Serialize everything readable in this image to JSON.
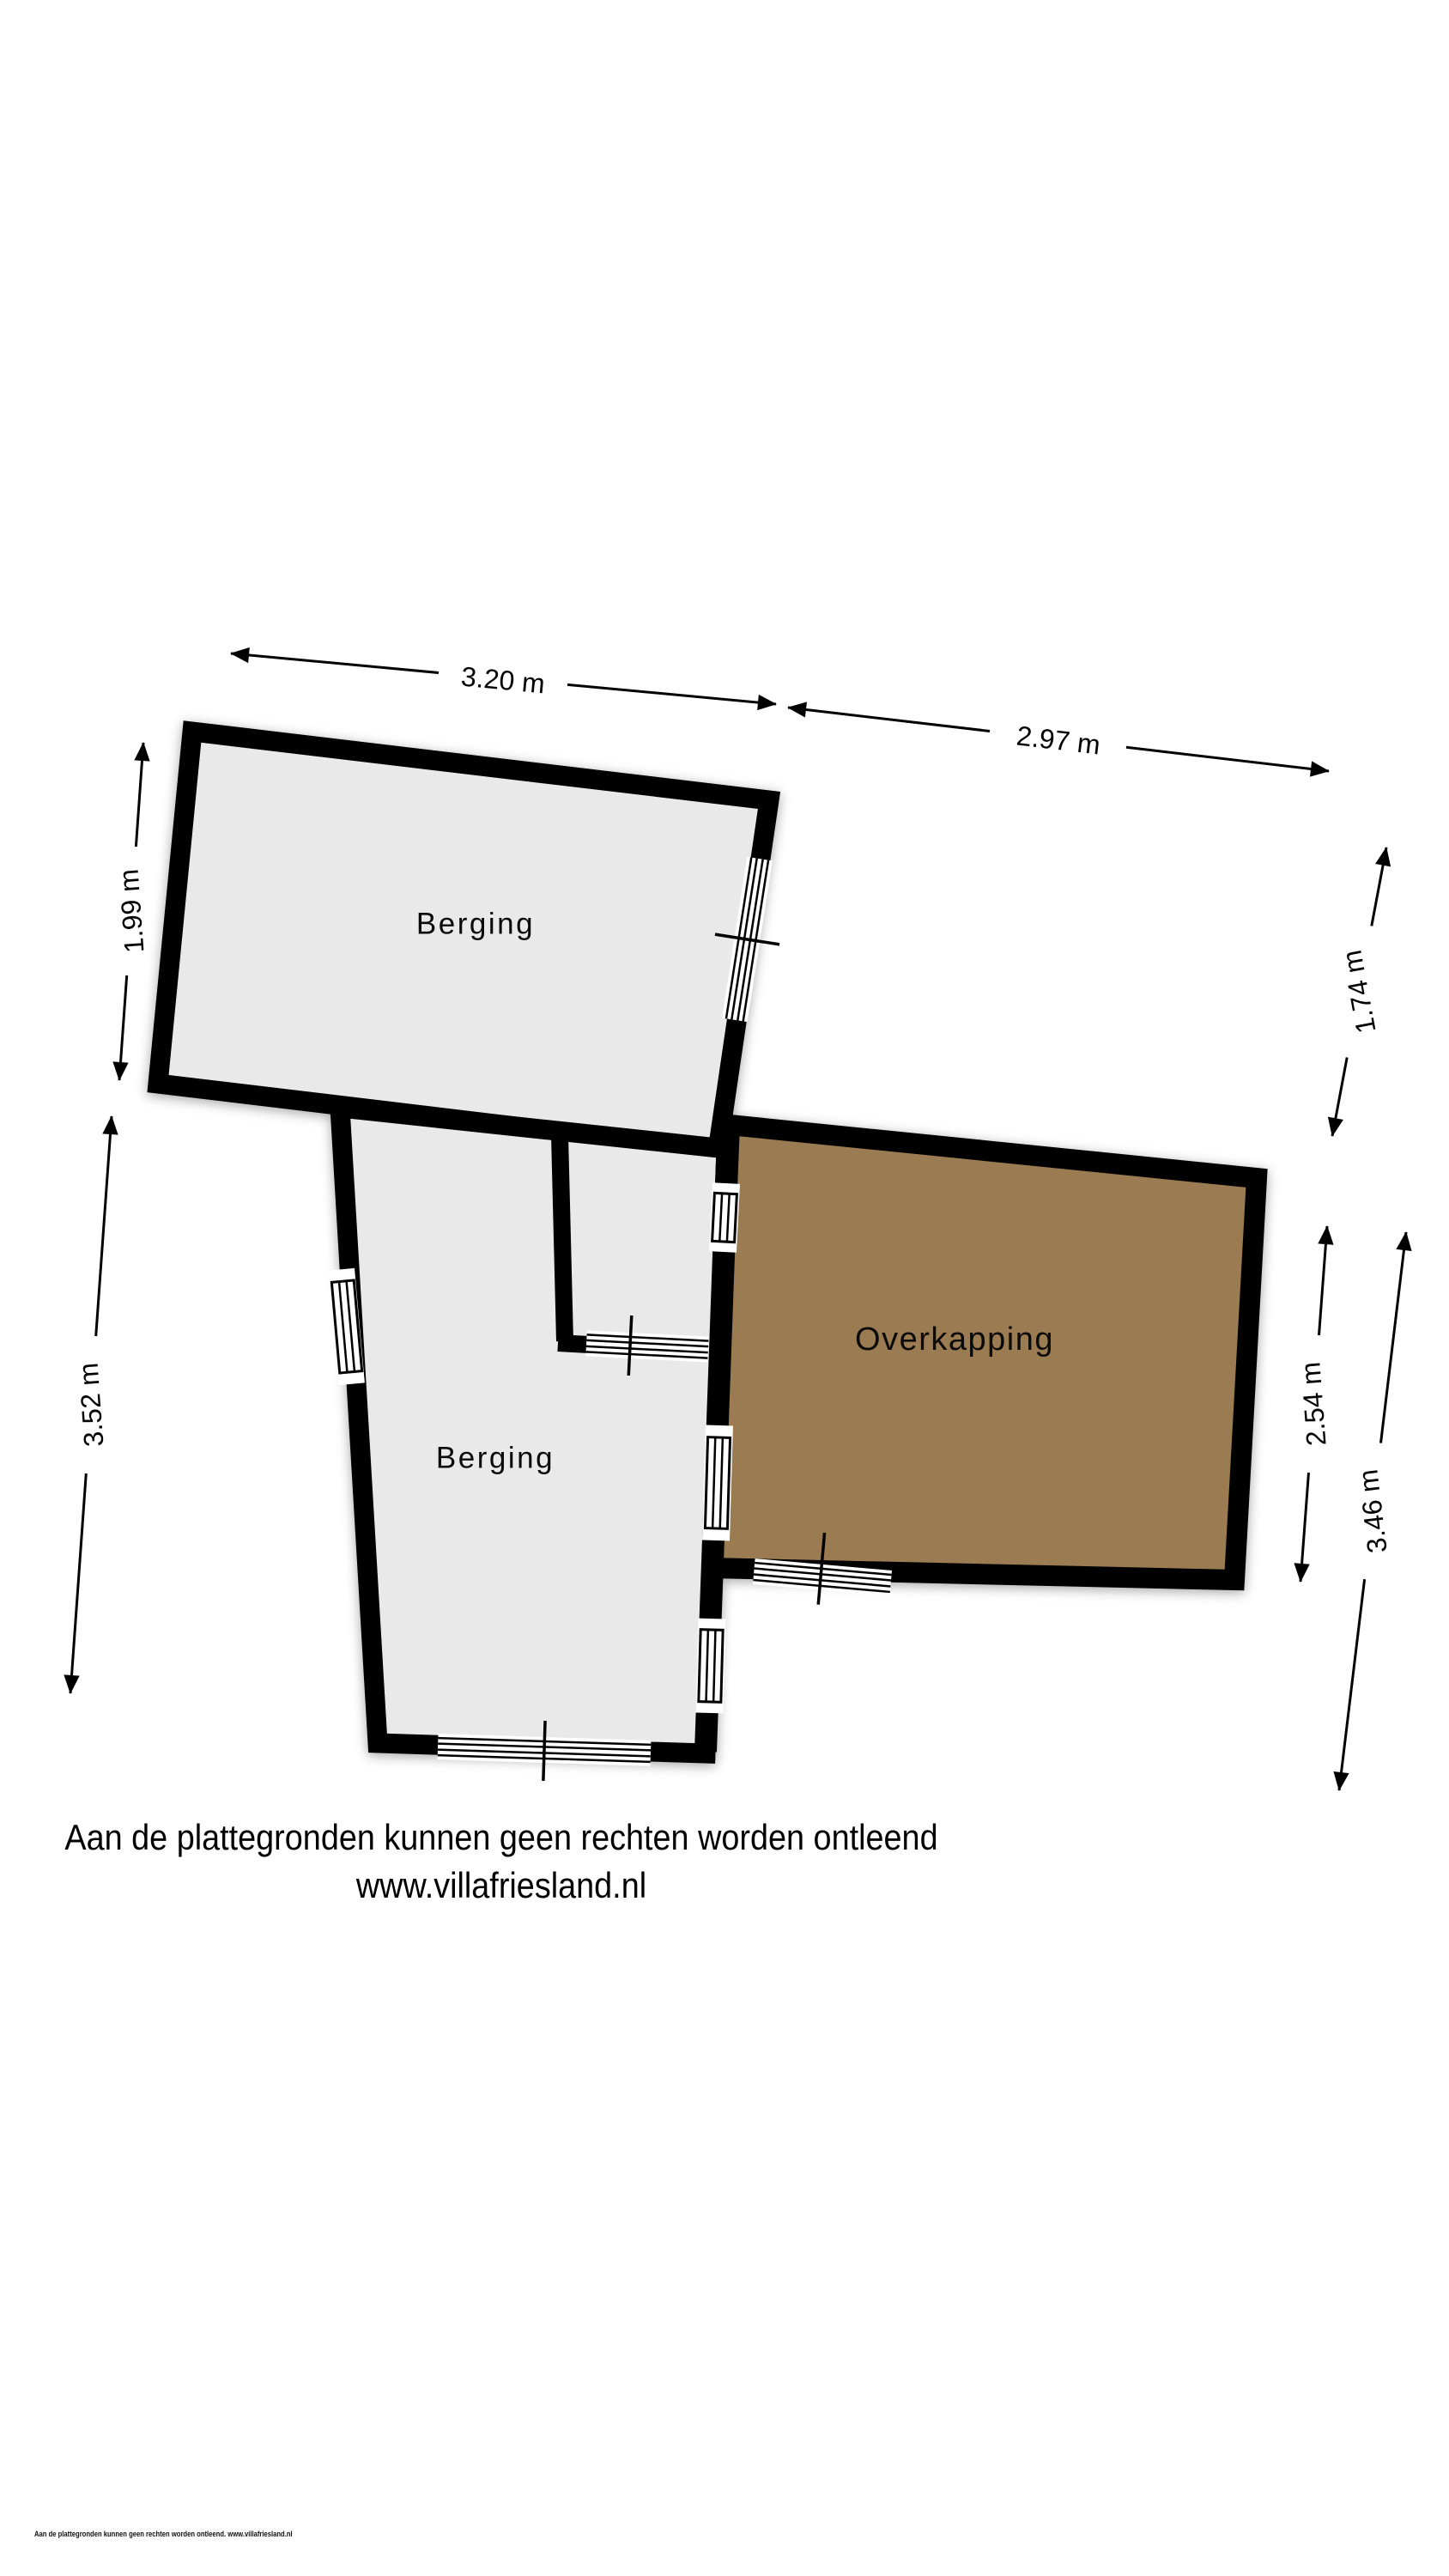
{
  "colors": {
    "background": "#ffffff",
    "wall": "#000000",
    "floor": "#e9e9e9",
    "overkapping_floor": "#9a7b52",
    "dimension": "#000000"
  },
  "rooms": {
    "berging_top": {
      "label": "Berging"
    },
    "berging_bottom": {
      "label": "Berging"
    },
    "overkapping": {
      "label": "Overkapping"
    }
  },
  "dimensions": {
    "top_width": "3.20 m",
    "top_right_width": "2.97 m",
    "upper_left_height": "1.99 m",
    "lower_left_height": "3.52 m",
    "upper_right_height": "1.74 m",
    "overkapping_height": "2.54 m",
    "total_right_height": "3.46 m"
  },
  "footer": {
    "disclaimer": "Aan de plattegronden kunnen geen rechten worden ontleend",
    "website": "www.villafriesland.nl",
    "fineprint": "Aan de plattegronden kunnen geen rechten worden ontleend. www.villafriesland.nl"
  }
}
